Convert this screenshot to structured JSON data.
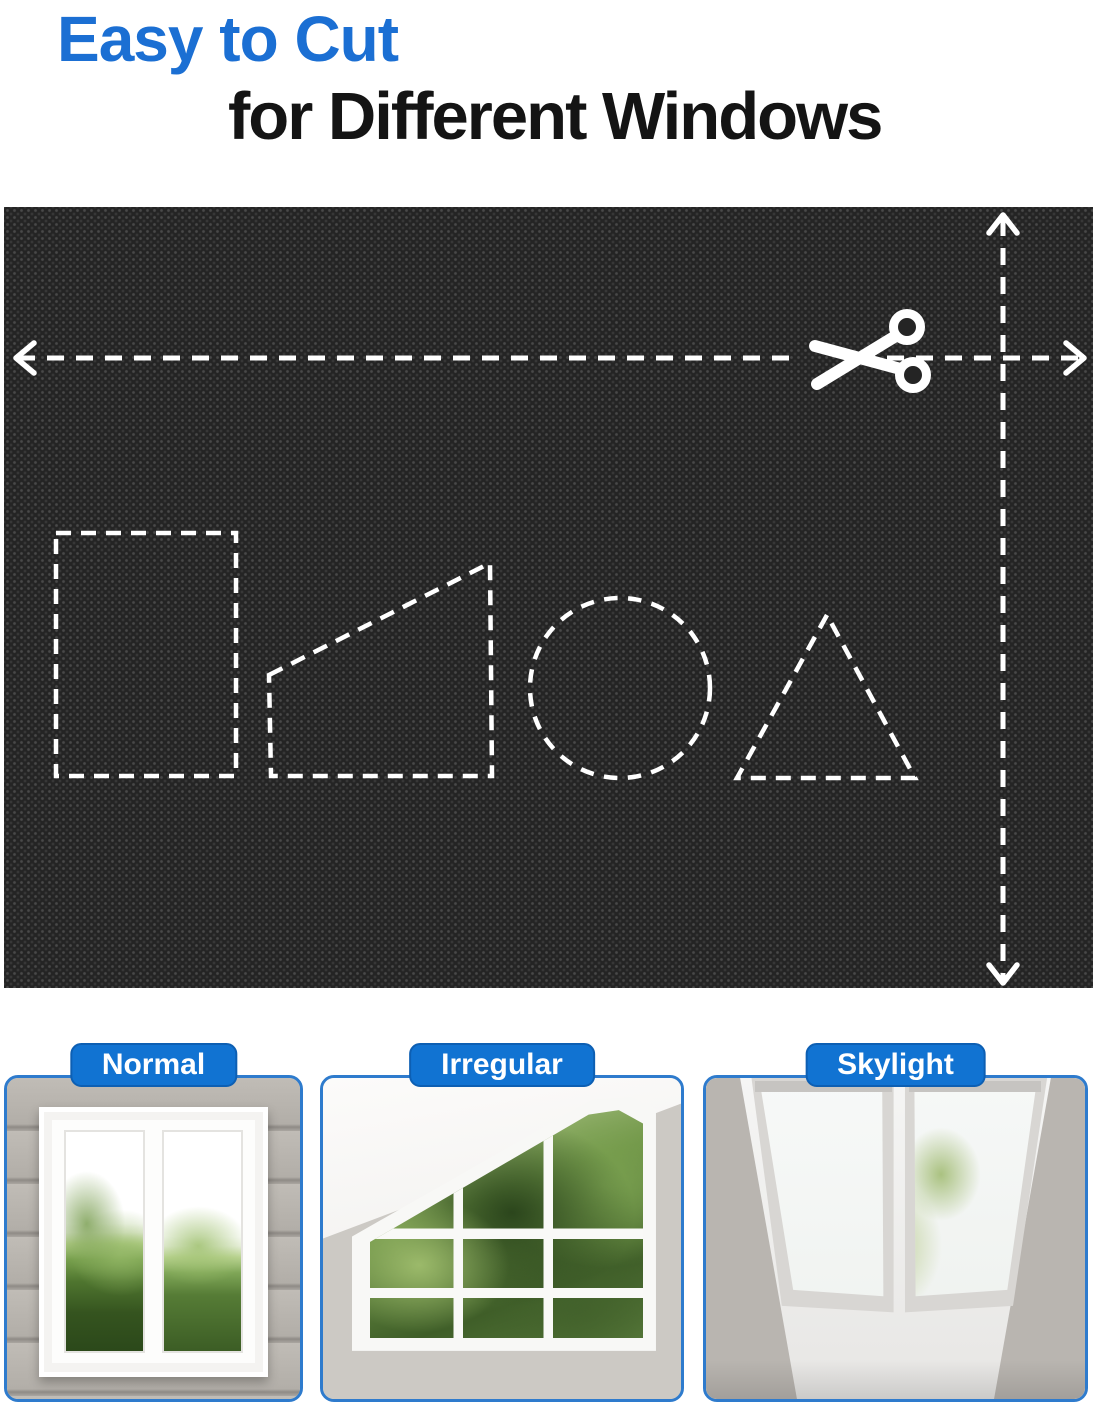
{
  "header": {
    "title_line1": "Easy to Cut",
    "title_line2": "for Different Windows",
    "accent_color": "#1b6fd3",
    "text_color": "#141414"
  },
  "fabric_board": {
    "description": "black woven blackout-fabric swatch with white dashed cutting guides",
    "base_color": "#242424",
    "guide_color": "#ffffff",
    "icons": [
      "scissors-icon",
      "left-arrowhead",
      "right-arrowhead",
      "up-arrowhead",
      "down-arrowhead"
    ],
    "cut_shapes": [
      "rectangle",
      "trapezoid",
      "circle",
      "triangle"
    ]
  },
  "window_examples": {
    "badge_color": "#1173d2",
    "badge_text_color": "#ffffff",
    "panel_border_color": "#2e7bcd",
    "items": [
      {
        "label": "Normal",
        "photo": "normal-double-window-with-hedge"
      },
      {
        "label": "Irregular",
        "photo": "slanted-attic-window-with-trees"
      },
      {
        "label": "Skylight",
        "photo": "two-roof-skylights-with-tree"
      }
    ]
  }
}
